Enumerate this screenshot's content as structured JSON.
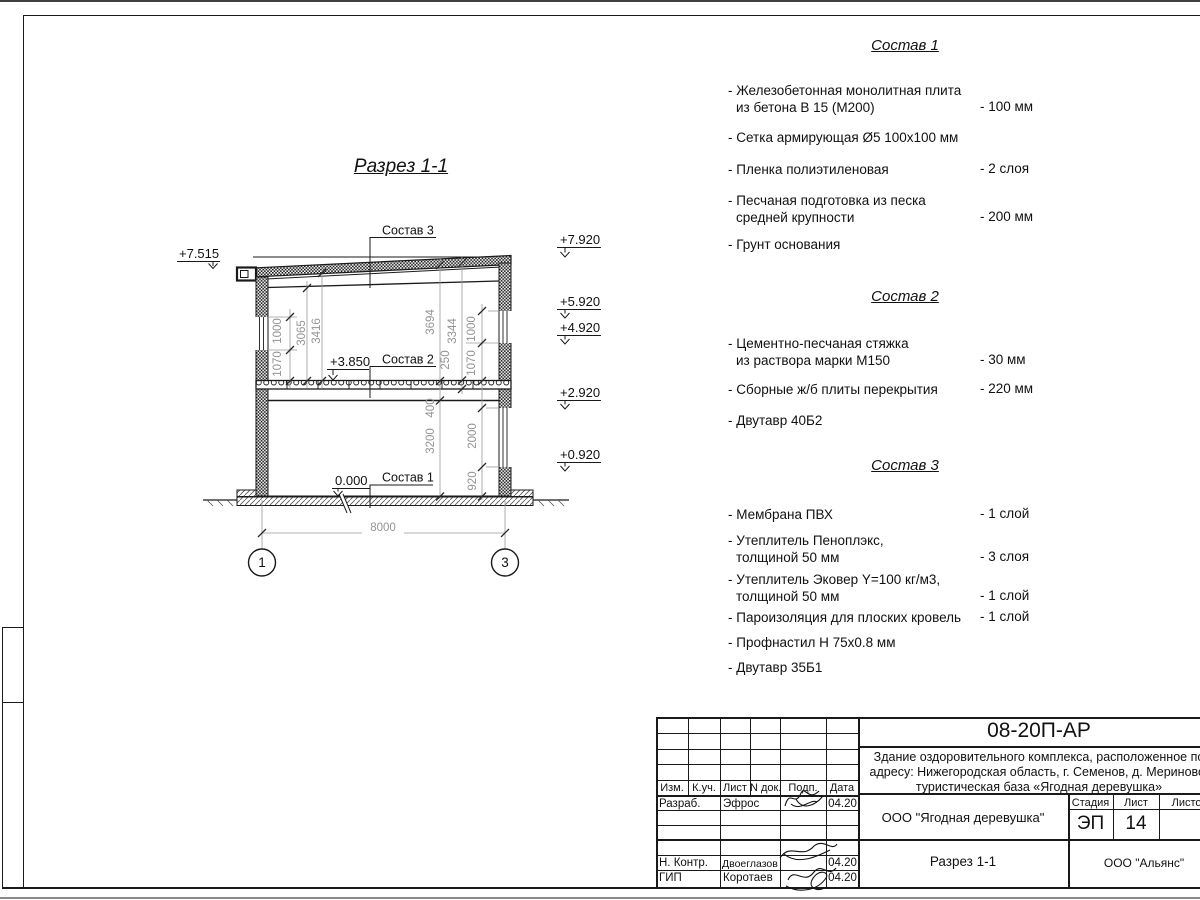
{
  "section": {
    "title": "Разрез 1-1",
    "label_sostav1": "Состав 1",
    "label_sostav2": "Состав 2",
    "label_sostav3": "Состав 3",
    "elev_7515": "+7.515",
    "elev_7920": "+7.920",
    "elev_5920": "+5.920",
    "elev_4920": "+4.920",
    "elev_2920": "+2.920",
    "elev_0920": "+0.920",
    "elev_3850": "+3.850",
    "elev_0000": "0.000",
    "dim_left_1000": "1000",
    "dim_left_1070": "1070",
    "dim_3065": "3065",
    "dim_3416": "3416",
    "dim_3694": "3694",
    "dim_3344": "3344",
    "dim_250": "250",
    "dim_right_1000": "1000",
    "dim_right_1070": "1070",
    "dim_400": "400",
    "dim_3200": "3200",
    "dim_2000": "2000",
    "dim_920": "920",
    "dim_8000": "8000",
    "axis_1": "1",
    "axis_3": "3"
  },
  "sostav1": {
    "title": "Состав 1",
    "items": [
      {
        "l1": "- Железобетонная  монолитная плита",
        "l2": "из бетона В 15 (М200)",
        "value": "- 100 мм"
      },
      {
        "l1": "- Сетка армирующая Ø5 100х100 мм",
        "l2": "",
        "value": ""
      },
      {
        "l1": "- Пленка полиэтиленовая",
        "l2": "",
        "value": "-  2 слоя"
      },
      {
        "l1": "- Песчаная подготовка из песка",
        "l2": "средней крупности",
        "value": "- 200 мм"
      },
      {
        "l1": "- Грунт основания",
        "l2": "",
        "value": ""
      }
    ]
  },
  "sostav2": {
    "title": "Состав 2",
    "items": [
      {
        "l1": "- Цементно-песчаная стяжка",
        "l2": "из раствора марки М150",
        "value": "- 30 мм"
      },
      {
        "l1": "- Сборные ж/б плиты перекрытия",
        "l2": "",
        "value": "- 220 мм"
      },
      {
        "l1": "- Двутавр 40Б2",
        "l2": "",
        "value": ""
      }
    ]
  },
  "sostav3": {
    "title": "Состав 3",
    "items": [
      {
        "l1": "- Мембрана ПВХ",
        "l2": "",
        "value": "- 1 слой"
      },
      {
        "l1": "- Утеплитель Пеноплэкс,",
        "l2": "толщиной 50 мм",
        "value": "- 3 слоя"
      },
      {
        "l1": "- Утеплитель Эковер Y=100 кг/м3,",
        "l2": "толщиной 50 мм",
        "value": "- 1 слой"
      },
      {
        "l1": "- Пароизоляция для плоских кровель",
        "l2": "",
        "value": "- 1 слой"
      },
      {
        "l1": "- Профнастил Н 75х0.8 мм",
        "l2": "",
        "value": ""
      },
      {
        "l1": "- Двутавр 35Б1",
        "l2": "",
        "value": ""
      }
    ]
  },
  "titleblock": {
    "code": "08-20П-АР",
    "project_line1": "Здание оздоровительного комплекса, расположенное по",
    "project_line2": "адресу: Нижегородская область, г. Семенов, д. Мериново,",
    "project_line3": "туристическая база «Ягодная деревушка»",
    "org": "ООО \"Ягодная деревушка\"",
    "stage_label": "Стадия",
    "sheet_label": "Лист",
    "sheets_label": "Листов",
    "stage": "ЭП",
    "sheet_num": "14",
    "view_name": "Разрез 1-1",
    "company": "ООО \"Альянс\"",
    "col_izm": "Изм.",
    "col_kuch": "К.уч.",
    "col_list": "Лист",
    "col_ndok": "N док.",
    "col_podp": "Подп.",
    "col_data": "Дата",
    "razrab_label": "Разраб.",
    "razrab_name": "Эфрос",
    "razrab_date": "04.20",
    "nkontr_label": "Н. Контр.",
    "nkontr_name": "Двоеглазов",
    "nkontr_date": "04.20",
    "gip_label": "ГИП",
    "gip_name": "Коротаев",
    "gip_date": "04.20"
  }
}
